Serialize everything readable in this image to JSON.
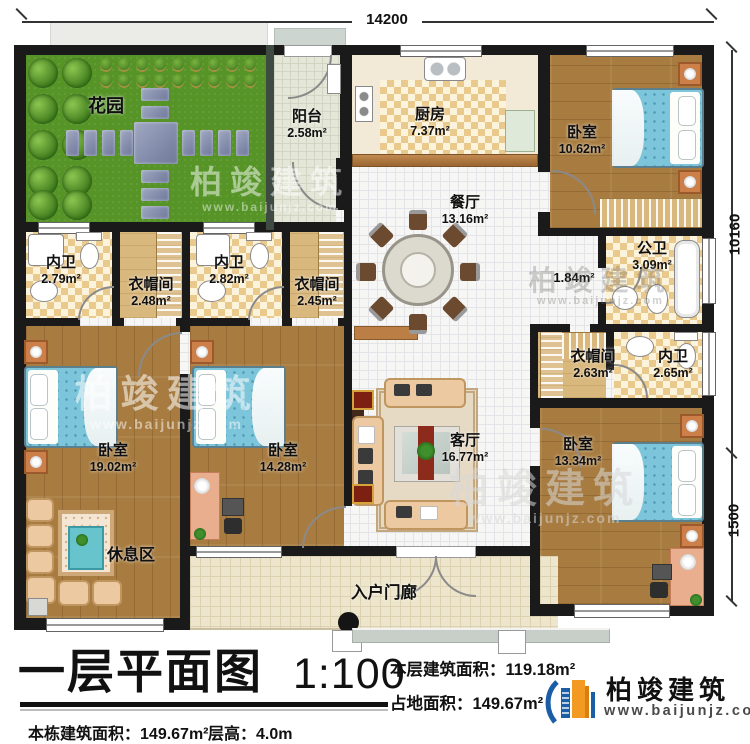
{
  "plan": {
    "rooms": {
      "garden": {
        "name": "花园"
      },
      "balcony": {
        "name": "阳台",
        "area": "2.58m²"
      },
      "kitchen": {
        "name": "厨房",
        "area": "7.37m²"
      },
      "bedroom_tr": {
        "name": "卧室",
        "area": "10.62m²"
      },
      "dining": {
        "name": "餐厅",
        "area": "13.16m²"
      },
      "bath1": {
        "name": "内卫",
        "area": "2.79m²"
      },
      "closet1": {
        "name": "衣帽间",
        "area": "2.48m²"
      },
      "bath2": {
        "name": "内卫",
        "area": "2.82m²"
      },
      "closet2": {
        "name": "衣帽间",
        "area": "2.45m²"
      },
      "public_bath": {
        "name": "公卫",
        "area": "3.09m²"
      },
      "hallway": {
        "area": "1.84m²"
      },
      "closet3": {
        "name": "衣帽间",
        "area": "2.63m²"
      },
      "bath3": {
        "name": "内卫",
        "area": "2.65m²"
      },
      "bedroom_left": {
        "name": "卧室",
        "area": "19.02m²"
      },
      "rest_area": {
        "name": "休息区"
      },
      "bedroom_mid": {
        "name": "卧室",
        "area": "14.28m²"
      },
      "living": {
        "name": "客厅",
        "area": "16.77m²"
      },
      "bedroom_br": {
        "name": "卧室",
        "area": "13.34m²"
      },
      "porch": {
        "name": "入户门廊"
      }
    },
    "dimensions": {
      "top": "14200",
      "right_upper": "10160",
      "right_lower": "1500"
    }
  },
  "title_block": {
    "title": "一层平面图",
    "scale": "1:100",
    "floor_area_label": "本层建筑面积：",
    "floor_area": "119.18m²",
    "land_area_label": "占地面积：",
    "land_area": "149.67m²",
    "total_area_label": "本栋建筑面积：",
    "total_area": "149.67m²",
    "height_label": "层高：",
    "height": "4.0m"
  },
  "logo": {
    "company": "柏竣建筑",
    "website": "www.baijunjz.com"
  },
  "watermark": {
    "brand": "柏竣建筑",
    "website": "www.baijunjz.com"
  },
  "colors": {
    "wall": "#1a1a1a",
    "wood_floor": "#a87c40",
    "grass": "#569427",
    "bed": "#7cc5da",
    "logo_blue": "#1b5ea6",
    "logo_orange": "#f29a21"
  }
}
